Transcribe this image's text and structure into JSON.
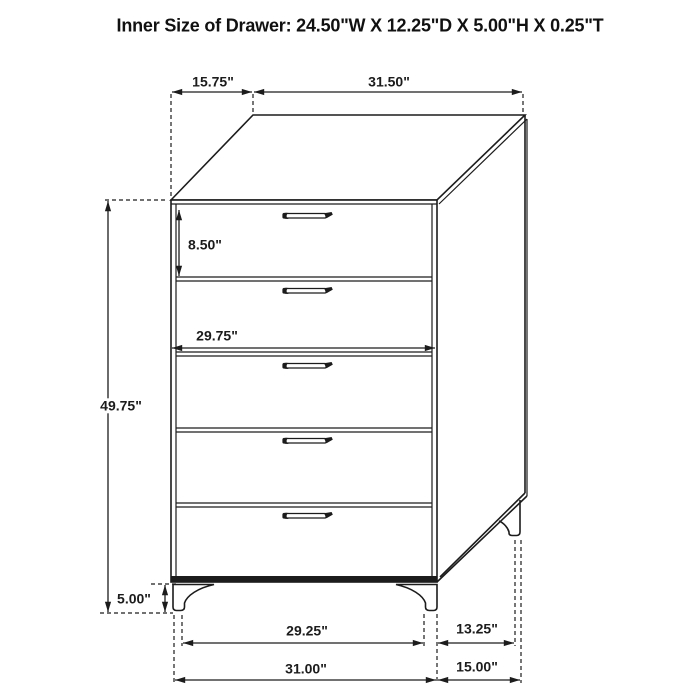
{
  "title": "Inner Size of Drawer: 24.50\"W X 12.25\"D X 5.00\"H X 0.25\"T",
  "dimension_labels": {
    "top_depth": "15.75\"",
    "top_width": "31.50\"",
    "top_drawer_height": "8.50\"",
    "drawer_front_width": "29.75\"",
    "overall_height": "49.75\"",
    "leg_height": "5.00\"",
    "foot_inner_width": "29.25\"",
    "foot_inner_depth": "13.25\"",
    "overall_width": "31.00\"",
    "overall_depth": "15.00\""
  },
  "figure": {
    "type": "furniture-dimension-diagram",
    "item": "5-drawer chest",
    "drawer_count": 5,
    "line_color": "#1c1c1c",
    "background_color": "#ffffff"
  }
}
